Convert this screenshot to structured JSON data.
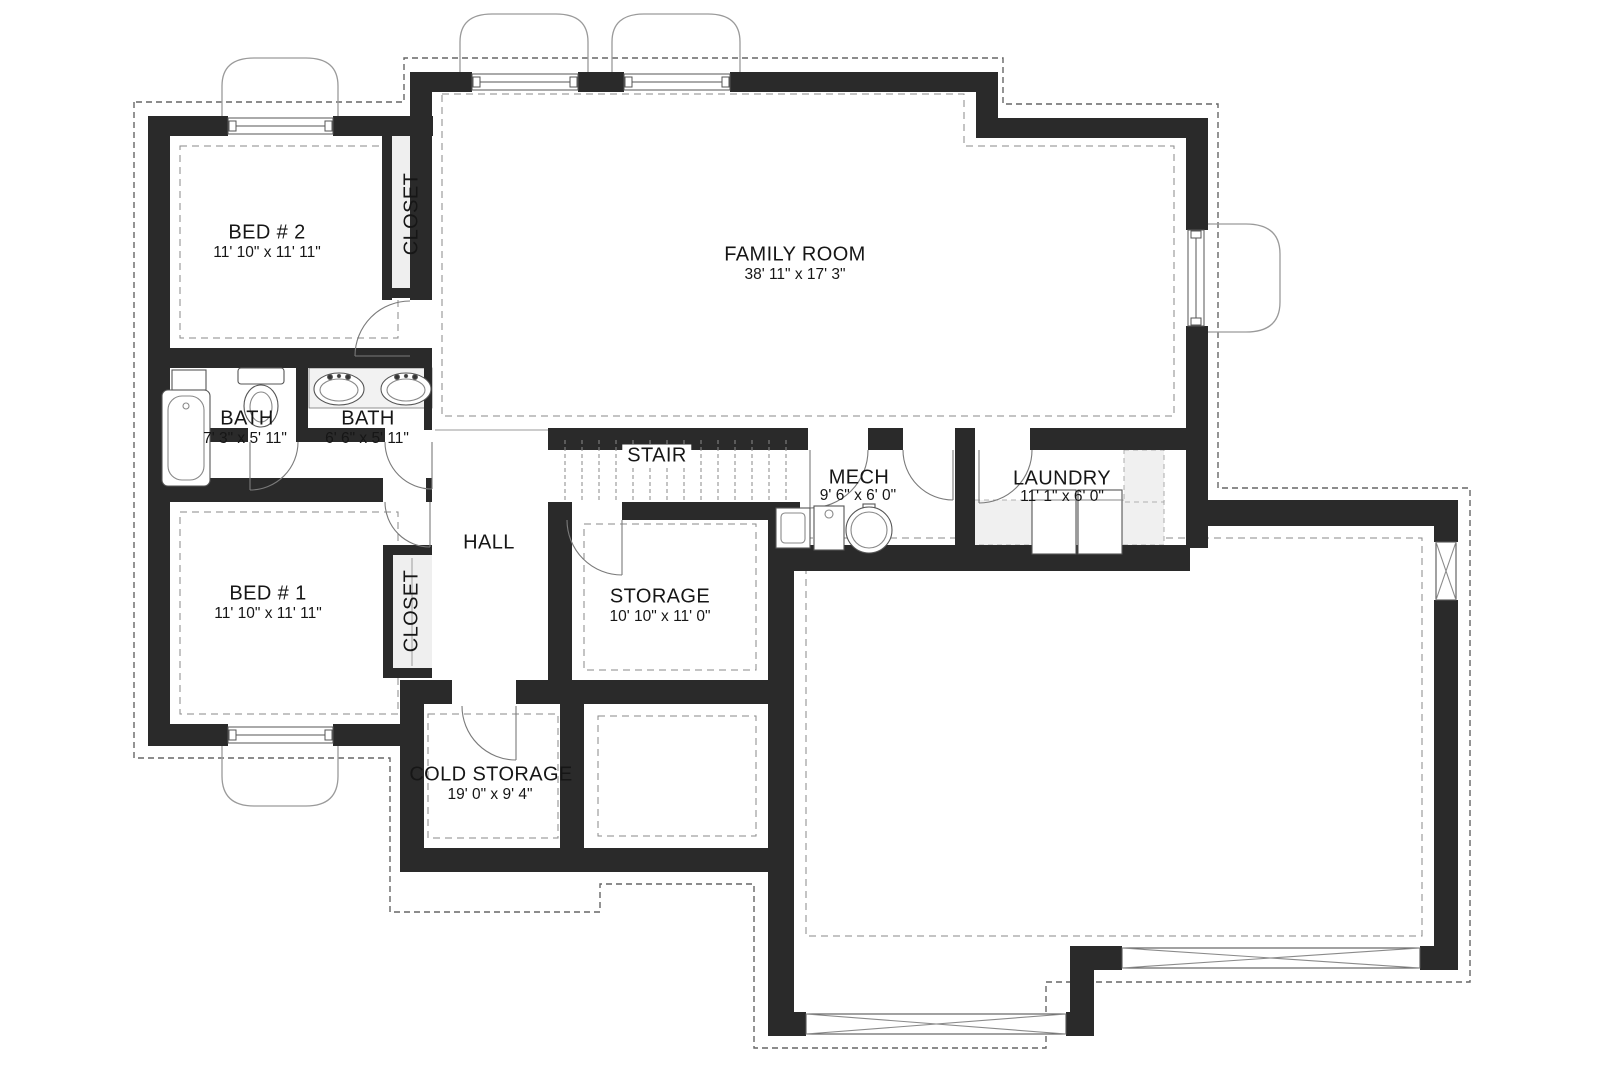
{
  "floor_plan": {
    "rooms": [
      {
        "id": "bed2",
        "label": "BED # 2",
        "dimensions": "11' 10\" x 11' 11\""
      },
      {
        "id": "closet-bed2",
        "label": "CLOSET",
        "dimensions": ""
      },
      {
        "id": "family-room",
        "label": "FAMILY ROOM",
        "dimensions": "38' 11\" x 17' 3\""
      },
      {
        "id": "bath-1",
        "label": "BATH",
        "dimensions": "7' 3\" x 5' 11\""
      },
      {
        "id": "bath-2",
        "label": "BATH",
        "dimensions": "6' 6\" x 5' 11\""
      },
      {
        "id": "stair",
        "label": "STAIR",
        "dimensions": ""
      },
      {
        "id": "mech",
        "label": "MECH",
        "dimensions": "9' 6\" x 6' 0\""
      },
      {
        "id": "laundry",
        "label": "LAUNDRY",
        "dimensions": "11' 1\" x 6' 0\""
      },
      {
        "id": "hall",
        "label": "HALL",
        "dimensions": ""
      },
      {
        "id": "bed1",
        "label": "BED # 1",
        "dimensions": "11' 10\" x 11' 11\""
      },
      {
        "id": "closet-bed1",
        "label": "CLOSET",
        "dimensions": ""
      },
      {
        "id": "storage",
        "label": "STORAGE",
        "dimensions": "10' 10\" x 11' 0\""
      },
      {
        "id": "cold-storage",
        "label": "COLD STORAGE",
        "dimensions": "19' 0\" x 9' 4\""
      }
    ],
    "colors": {
      "wall": "#2a2a2a",
      "thin_line": "#6e6e6e",
      "well_line": "#9a9a9a",
      "dash_line": "#666666",
      "light_fill": "#f0f0f0",
      "text": "#161616"
    }
  }
}
